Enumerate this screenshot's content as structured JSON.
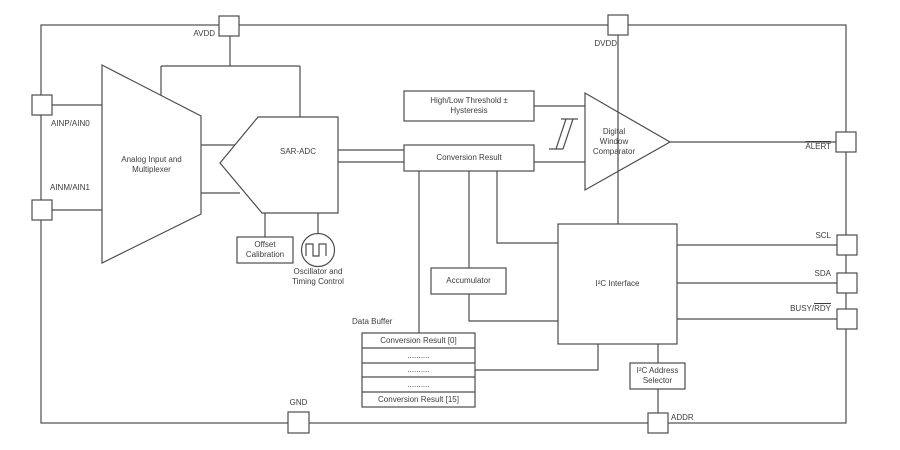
{
  "colors": {
    "line": "#4d4d4d",
    "text": "#3d3d3d",
    "background": "#ffffff"
  },
  "pins": {
    "avdd": "AVDD",
    "dvdd": "DVDD",
    "ainp": "AINP/AIN0",
    "ainm": "AINM/AIN1",
    "alert": "ALERT",
    "scl": "SCL",
    "sda": "SDA",
    "busy_prefix": "BUSY/",
    "busy_overlined": "RDY",
    "gnd": "GND",
    "addr": "ADDR"
  },
  "blocks": {
    "multiplexer": "Analog Input and Multiplexer",
    "sar_adc": "SAR-ADC",
    "offset_calibration": "Offset Calibration",
    "oscillator": "Oscillator and Timing Control",
    "threshold": "High/Low Threshold ± Hysteresis",
    "conversion_result": "Conversion Result",
    "comparator": "Digital Window Comparator",
    "accumulator": "Accumulator",
    "i2c_interface": "I²C Interface",
    "i2c_address_selector": "I²C Address Selector",
    "data_buffer_title": "Data Buffer"
  },
  "data_buffer": {
    "rows": [
      "Conversion Result [0]",
      "..........",
      "..........",
      "..........",
      "Conversion Result [15]"
    ]
  }
}
